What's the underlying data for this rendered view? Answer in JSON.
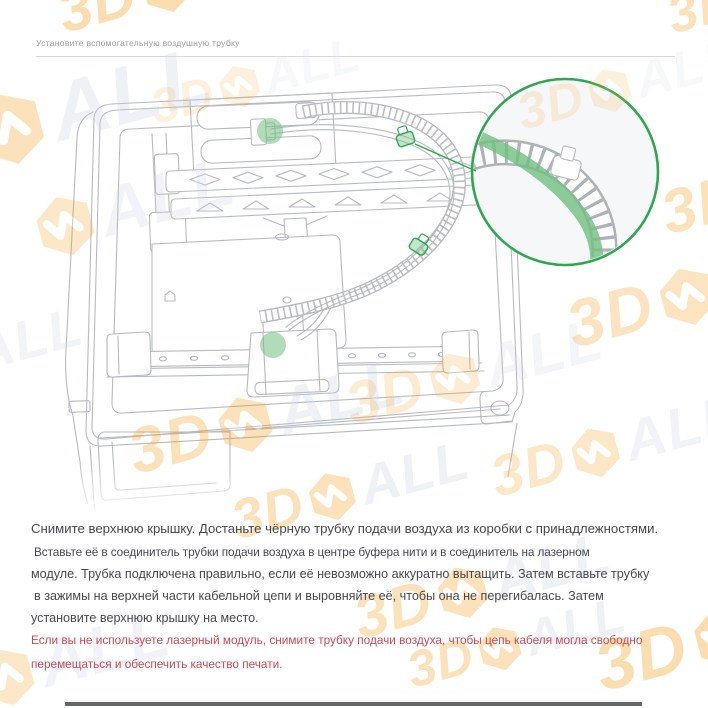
{
  "page": {
    "title": "Установите вспомогательную воздушную трубку"
  },
  "theme": {
    "accent_green": "#2EA84F",
    "fill_green": "#6FBF7E",
    "line": "#B6BAC0",
    "text": "#47484D",
    "muted": "#9B9B9B",
    "warning": "#C84A54",
    "divider": "#D9D9D9",
    "mag_bg": "#F6F7F8",
    "wm_orange": "#F6A21F",
    "wm_gray": "#CAD2E4",
    "bottom_bar": "#4A4B4F"
  },
  "watermark": {
    "text_3d": "3D",
    "text_all": "ALL",
    "instances": [
      {
        "x": 52,
        "y": -14,
        "s": 1.35,
        "o": 0.35,
        "v": "full"
      },
      {
        "x": 662,
        "y": -8,
        "s": 1.2,
        "o": 0.3,
        "v": "full"
      },
      {
        "x": -148,
        "y": 128,
        "s": 1.85,
        "o": 0.3,
        "v": "full"
      },
      {
        "x": 146,
        "y": 86,
        "s": 1.1,
        "o": 0.15,
        "v": "full"
      },
      {
        "x": 512,
        "y": 90,
        "s": 1.15,
        "o": 0.15,
        "v": "full"
      },
      {
        "x": 28,
        "y": 200,
        "s": 1.55,
        "o": 0.25,
        "v": "mall"
      },
      {
        "x": 655,
        "y": 186,
        "s": 1.4,
        "o": 0.3,
        "v": "full"
      },
      {
        "x": 122,
        "y": 424,
        "s": 1.45,
        "o": 0.3,
        "v": "full"
      },
      {
        "x": 560,
        "y": 296,
        "s": 1.5,
        "o": 0.28,
        "v": "full"
      },
      {
        "x": 340,
        "y": 378,
        "s": 1.35,
        "o": 0.2,
        "v": "full"
      },
      {
        "x": 485,
        "y": 452,
        "s": 1.3,
        "o": 0.25,
        "v": "full"
      },
      {
        "x": -84,
        "y": 342,
        "s": 1.25,
        "o": 0.22,
        "v": "mall"
      },
      {
        "x": 226,
        "y": 496,
        "s": 1.25,
        "o": 0.3,
        "v": "full"
      },
      {
        "x": 348,
        "y": 592,
        "s": 1.35,
        "o": 0.3,
        "v": "full"
      },
      {
        "x": 402,
        "y": 648,
        "s": 1.15,
        "o": 0.3,
        "v": "full"
      },
      {
        "x": 588,
        "y": 636,
        "s": 1.6,
        "o": 0.35,
        "v": "full"
      },
      {
        "x": -30,
        "y": 652,
        "s": 1.5,
        "o": 0.25,
        "v": "mall"
      }
    ]
  },
  "figure": {
    "type": "technical-illustration",
    "subject": "printer interior top view with air tube routed along cable chain",
    "markers": [
      "tube-connector-buffer",
      "chain-clip-top",
      "chain-clip-middle",
      "tube-connector-module",
      "magnifier-callout"
    ]
  },
  "body": {
    "paragraph_lines": [
      {
        "text": "Снимите верхнюю крышку. Достаньте чёрную трубку подачи воздуха из коробки с принадлежностями.",
        "style": "lead"
      },
      {
        "text": "Вставьте её в соединитель трубки подачи воздуха в центре буфера нити и в соединитель на лазерном",
        "style": "small indent"
      },
      {
        "text": "модуле. Трубка подключена правильно, если её невозможно аккуратно вытащить. Затем вставьте трубку",
        "style": "normal"
      },
      {
        "text": "в зажимы на верхней части кабельной цепи и выровняйте её, чтобы она не перегибалась. Затем",
        "style": "normal indent"
      },
      {
        "text": "установите верхнюю крышку на место.",
        "style": "normal"
      }
    ],
    "warning_lines": [
      {
        "text": "Если вы не используете лазерный модуль, снимите трубку подачи воздуха, чтобы цепь кабеля могла свободно",
        "style": "warn gap-top"
      },
      {
        "text": "перемещаться и обеспечить качество печати.",
        "style": "warn"
      }
    ]
  }
}
